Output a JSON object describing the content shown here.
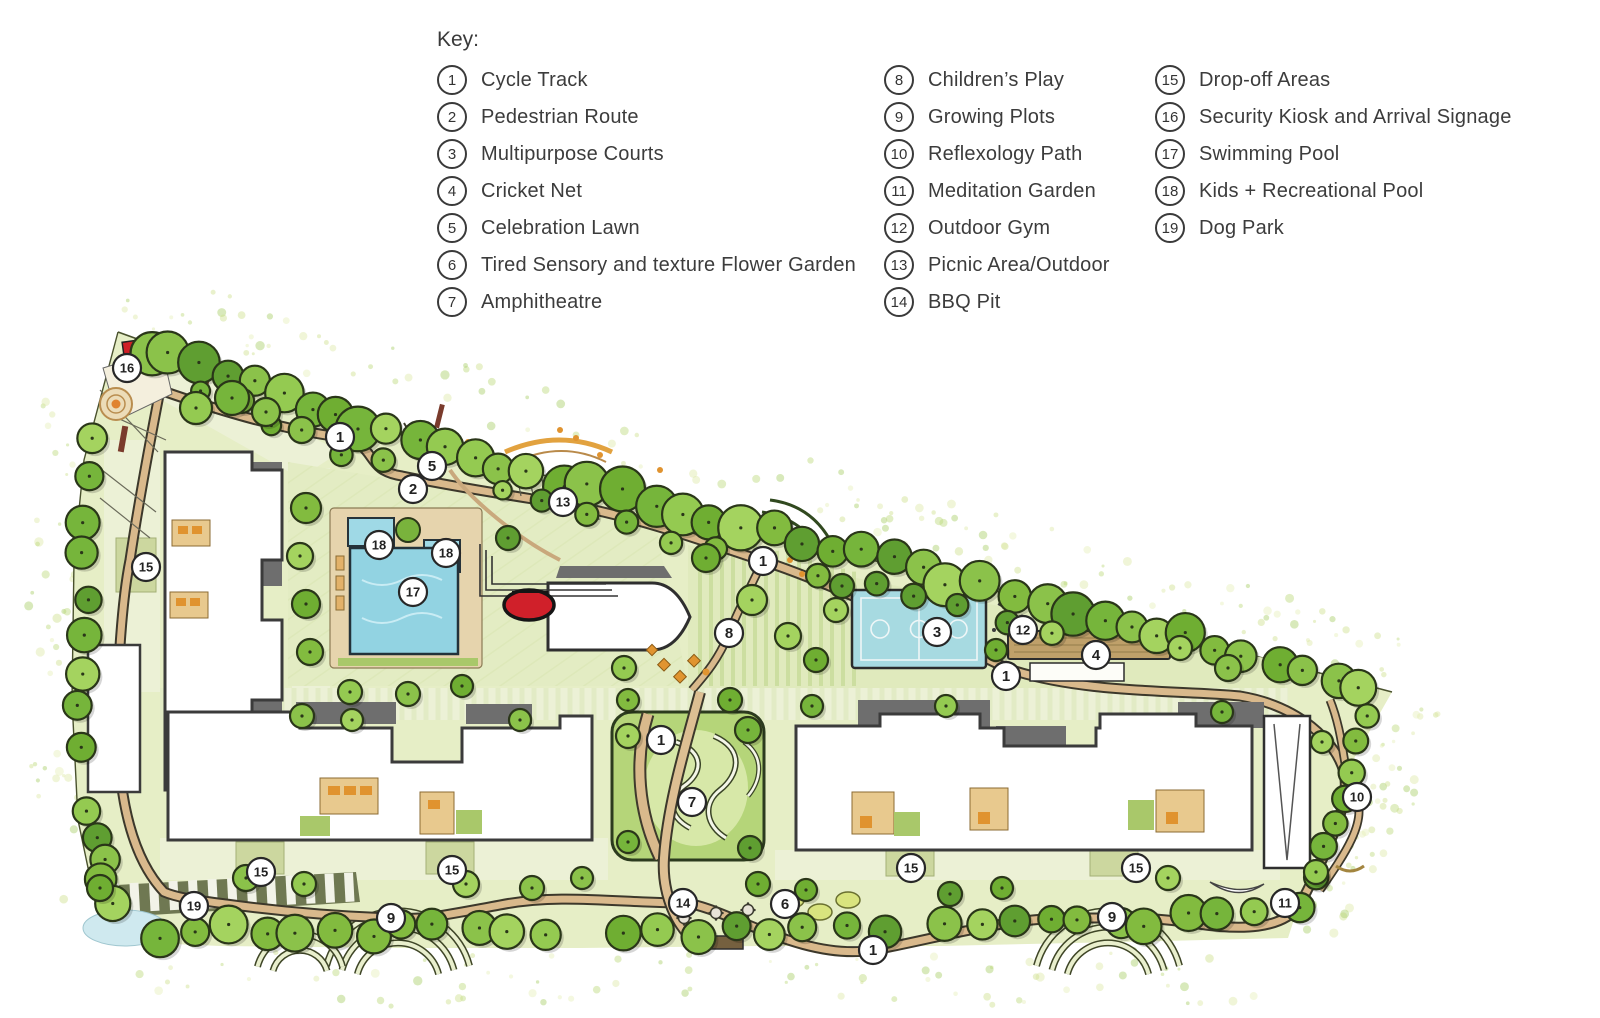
{
  "legend": {
    "title": "Key:",
    "columns": [
      {
        "items": [
          {
            "num": "1",
            "label": "Cycle Track"
          },
          {
            "num": "2",
            "label": "Pedestrian Route"
          },
          {
            "num": "3",
            "label": "Multipurpose Courts"
          },
          {
            "num": "4",
            "label": "Cricket Net"
          },
          {
            "num": "5",
            "label": "Celebration Lawn"
          },
          {
            "num": "6",
            "label": "Tired Sensory and texture Flower Garden"
          },
          {
            "num": "7",
            "label": "Amphitheatre"
          }
        ]
      },
      {
        "items": [
          {
            "num": "8",
            "label": "Children’s Play"
          },
          {
            "num": "9",
            "label": "Growing Plots"
          },
          {
            "num": "10",
            "label": "Reflexology Path"
          },
          {
            "num": "11",
            "label": "Meditation Garden"
          },
          {
            "num": "12",
            "label": "Outdoor Gym"
          },
          {
            "num": "13",
            "label": "Picnic Area/Outdoor"
          },
          {
            "num": "14",
            "label": "BBQ Pit"
          }
        ]
      },
      {
        "items": [
          {
            "num": "15",
            "label": "Drop-off Areas"
          },
          {
            "num": "16",
            "label": "Security Kiosk and Arrival Signage"
          },
          {
            "num": "17",
            "label": "Swimming Pool"
          },
          {
            "num": "18",
            "label": "Kids + Recreational Pool"
          },
          {
            "num": "19",
            "label": "Dog Park"
          }
        ]
      }
    ]
  },
  "map": {
    "markers": [
      {
        "num": "16",
        "x": 127,
        "y": 368
      },
      {
        "num": "1",
        "x": 340,
        "y": 437
      },
      {
        "num": "5",
        "x": 432,
        "y": 466
      },
      {
        "num": "2",
        "x": 413,
        "y": 489
      },
      {
        "num": "13",
        "x": 563,
        "y": 502
      },
      {
        "num": "18",
        "x": 379,
        "y": 545
      },
      {
        "num": "18",
        "x": 446,
        "y": 553
      },
      {
        "num": "17",
        "x": 413,
        "y": 592
      },
      {
        "num": "15",
        "x": 146,
        "y": 567
      },
      {
        "num": "1",
        "x": 763,
        "y": 561
      },
      {
        "num": "8",
        "x": 729,
        "y": 633
      },
      {
        "num": "3",
        "x": 937,
        "y": 632
      },
      {
        "num": "12",
        "x": 1023,
        "y": 630
      },
      {
        "num": "4",
        "x": 1096,
        "y": 655
      },
      {
        "num": "1",
        "x": 1006,
        "y": 676
      },
      {
        "num": "1",
        "x": 661,
        "y": 740
      },
      {
        "num": "7",
        "x": 692,
        "y": 802
      },
      {
        "num": "10",
        "x": 1357,
        "y": 797
      },
      {
        "num": "15",
        "x": 261,
        "y": 872
      },
      {
        "num": "15",
        "x": 452,
        "y": 870
      },
      {
        "num": "19",
        "x": 194,
        "y": 906
      },
      {
        "num": "9",
        "x": 391,
        "y": 918
      },
      {
        "num": "14",
        "x": 683,
        "y": 903
      },
      {
        "num": "6",
        "x": 785,
        "y": 904
      },
      {
        "num": "1",
        "x": 873,
        "y": 950
      },
      {
        "num": "15",
        "x": 911,
        "y": 868
      },
      {
        "num": "15",
        "x": 1136,
        "y": 868
      },
      {
        "num": "9",
        "x": 1112,
        "y": 917
      },
      {
        "num": "11",
        "x": 1285,
        "y": 903
      }
    ],
    "colors": {
      "ground": "#e6eec6",
      "road": "#ecf1d6",
      "path_tan": "#d9b98c",
      "pool_blue": "#92d3e2",
      "court_blue": "#a7dae1",
      "accent_red": "#d0202a",
      "marker_stroke": "#272727",
      "tree_outline": "#2a3619"
    }
  }
}
